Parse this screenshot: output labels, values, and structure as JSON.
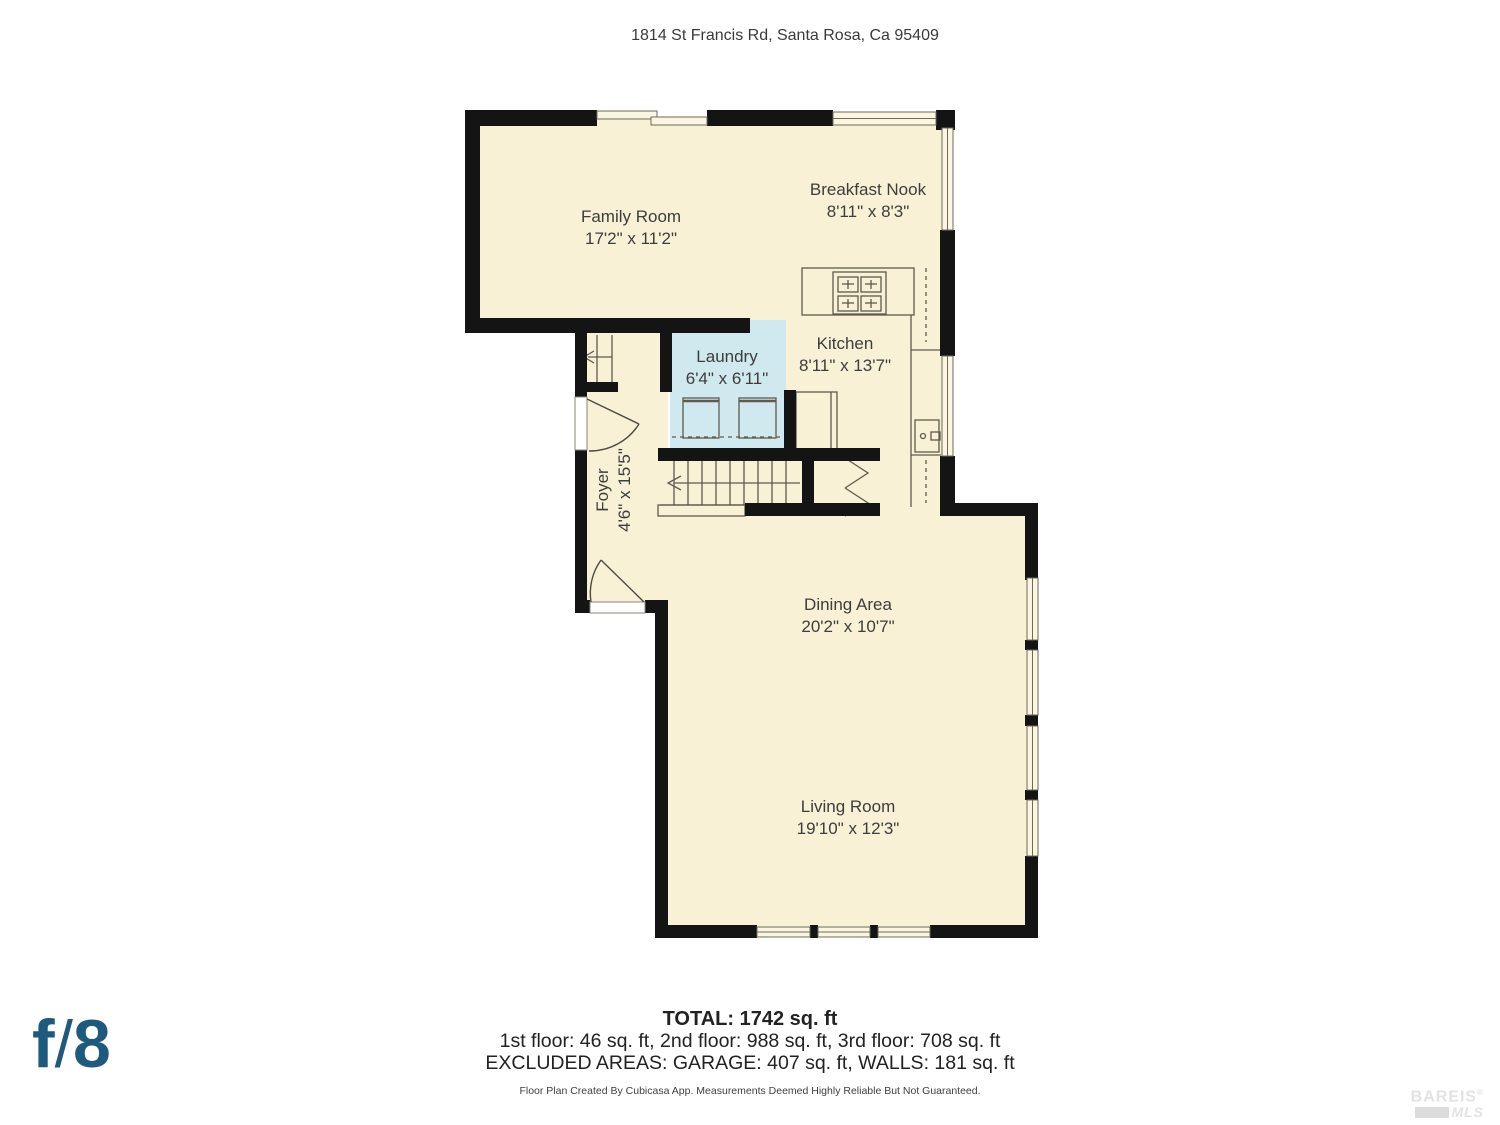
{
  "header": {
    "address": "1814 St Francis Rd, Santa Rosa, Ca 95409"
  },
  "rooms": [
    {
      "name": "Family Room",
      "dims": "17'2\" x 11'2\""
    },
    {
      "name": "Breakfast Nook",
      "dims": "8'11\" x 8'3\""
    },
    {
      "name": "Laundry",
      "dims": "6'4\" x 6'11\""
    },
    {
      "name": "Kitchen",
      "dims": "8'11\" x 13'7\""
    },
    {
      "name": "Foyer",
      "dims": "4'6\" x 15'5\""
    },
    {
      "name": "Dining Area",
      "dims": "20'2\" x 10'7\""
    },
    {
      "name": "Living Room",
      "dims": "19'10\" x 12'3\""
    }
  ],
  "summary": {
    "total": "TOTAL: 1742 sq. ft",
    "floors": "1st floor: 46 sq. ft, 2nd floor: 988 sq. ft, 3rd floor: 708 sq. ft",
    "excluded": "EXCLUDED AREAS: GARAGE: 407 sq. ft, WALLS: 181 sq. ft",
    "disclaimer": "Floor Plan Created By Cubicasa App. Measurements Deemed Highly Reliable But Not Guaranteed."
  },
  "branding": {
    "logo_f": "f",
    "logo_slash": "/",
    "logo_eight": "8",
    "mls_name": "BAREIS",
    "mls_reg": "®",
    "mls_suffix": "MLS"
  },
  "colors": {
    "wall": "#141414",
    "room_fill": "#f8f1d6",
    "laundry_fill": "#cfe9ee",
    "window_fill": "#fbf5e1",
    "thin_line": "#5e5a4d",
    "logo_blue": "#1d5a7d",
    "watermark_gray": "#e2e2e2"
  }
}
